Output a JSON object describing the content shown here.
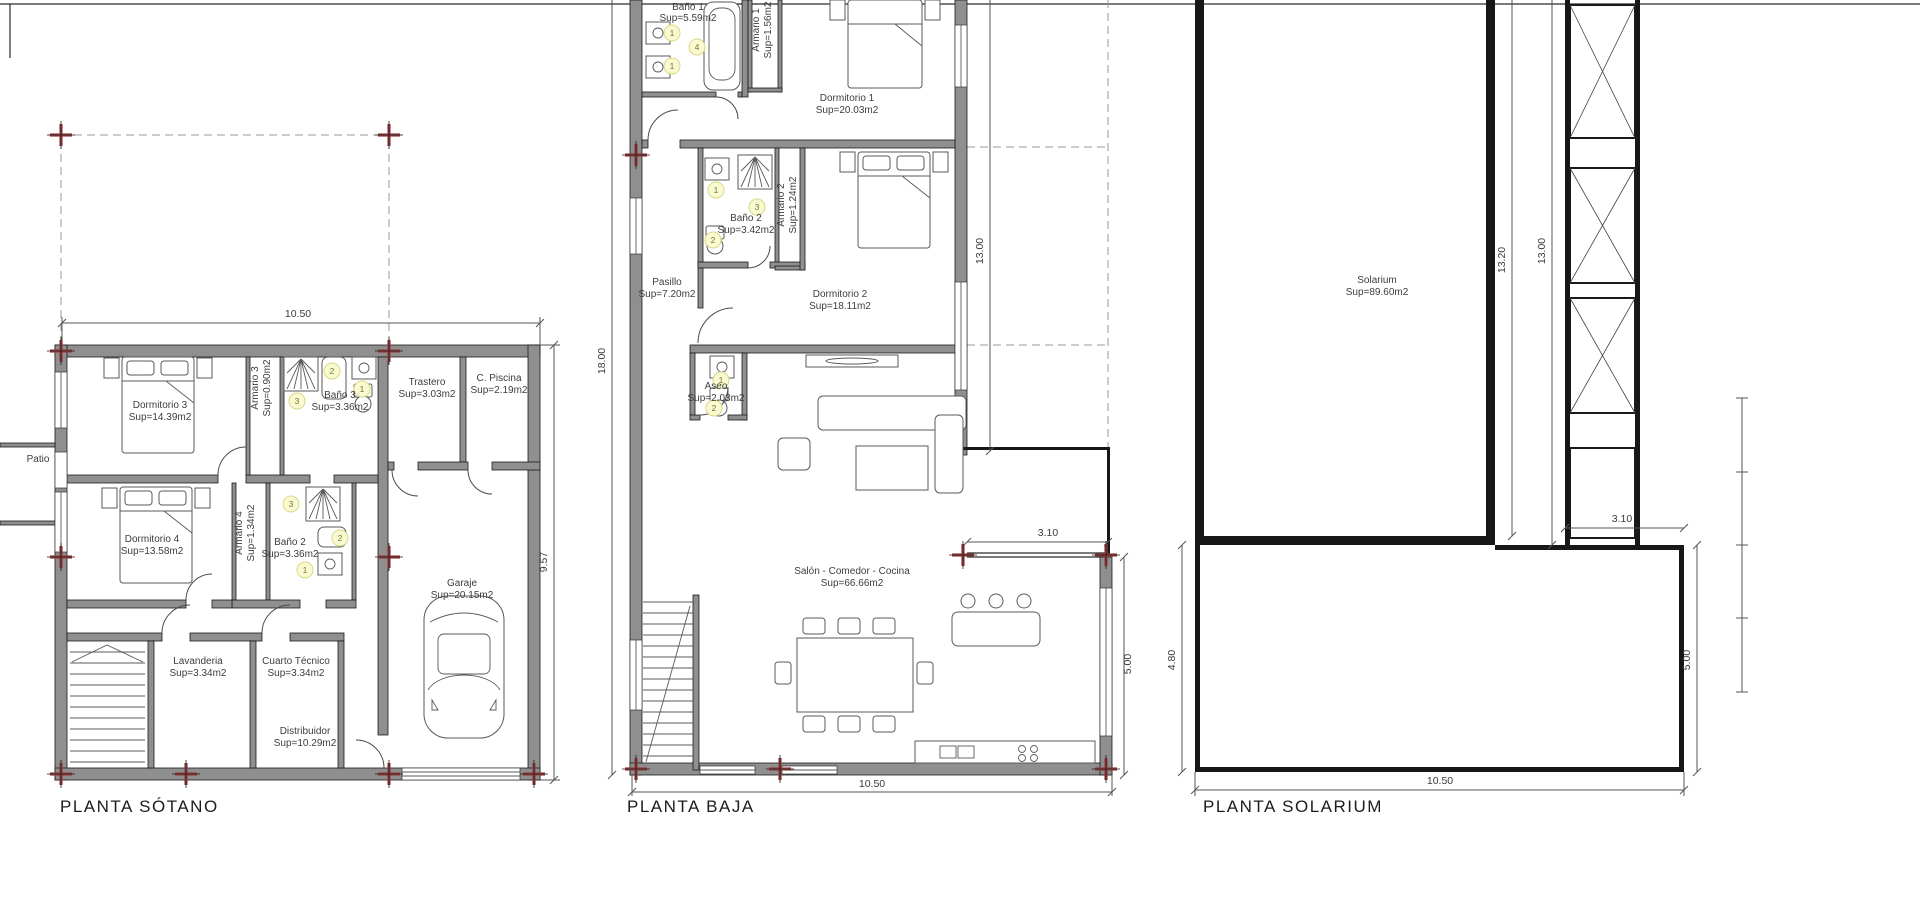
{
  "plans": {
    "sotano": {
      "title": "PLANTA SÓTANO",
      "dims": {
        "width": "10.50",
        "height": "9.57"
      },
      "rooms": {
        "patio": {
          "name": "Patio"
        },
        "dormitorio3": {
          "name": "Dormitorio 3",
          "sup": "Sup=14.39m2"
        },
        "armario3": {
          "name": "Armario 3",
          "sup": "Sup=0.90m2"
        },
        "bano3": {
          "name": "Baño 3",
          "sup": "Sup=3.36m2"
        },
        "trastero": {
          "name": "Trastero",
          "sup": "Sup=3.03m2"
        },
        "cpiscina": {
          "name": "C. Piscina",
          "sup": "Sup=2.19m2"
        },
        "dormitorio4": {
          "name": "Dormitorio 4",
          "sup": "Sup=13.58m2"
        },
        "armario4": {
          "name": "Armario 4",
          "sup": "Sup=1.34m2"
        },
        "bano2": {
          "name": "Baño 2",
          "sup": "Sup=3.36m2"
        },
        "garaje": {
          "name": "Garaje",
          "sup": "Sup=20.15m2"
        },
        "lavanderia": {
          "name": "Lavanderia",
          "sup": "Sup=3.34m2"
        },
        "cuartotecnico": {
          "name": "Cuarto Técnico",
          "sup": "Sup=3.34m2"
        },
        "distribuidor": {
          "name": "Distribuidor",
          "sup": "Sup=10.29m2"
        }
      },
      "markers": {
        "bano3_2": "2",
        "bano3_1": "1",
        "bano3_3": "3",
        "bano2_3": "3",
        "bano2_2": "2",
        "bano2_1": "1"
      }
    },
    "baja": {
      "title": "PLANTA BAJA",
      "dims": {
        "left": "18.00",
        "right_upper": "13.00",
        "terrace_width": "3.10",
        "right_lower": "5.00",
        "bottom": "10.50"
      },
      "rooms": {
        "bano1": {
          "name": "Baño 1",
          "sup": "Sup=5.59m2"
        },
        "armario1": {
          "name": "Armario 1",
          "sup": "Sup=1.56m2"
        },
        "dormitorio1": {
          "name": "Dormitorio 1",
          "sup": "Sup=20.03m2"
        },
        "bano2": {
          "name": "Baño 2",
          "sup": "Sup=3.42m2"
        },
        "armario2": {
          "name": "Armario 2",
          "sup": "Sup=1.24m2"
        },
        "pasillo": {
          "name": "Pasillo",
          "sup": "Sup=7.20m2"
        },
        "dormitorio2": {
          "name": "Dormitorio 2",
          "sup": "Sup=18.11m2"
        },
        "aseo": {
          "name": "Aseo",
          "sup": "Sup=2.03m2"
        },
        "salon": {
          "name": "Salón - Comedor - Cocina",
          "sup": "Sup=66.66m2"
        }
      },
      "markers": {
        "bano1_1a": "1",
        "bano1_1b": "1",
        "bano1_4": "4",
        "bano2_1": "1",
        "bano2_3": "3",
        "bano2_2": "2",
        "aseo_1": "1",
        "aseo_2": "2"
      }
    },
    "solarium": {
      "title": "PLANTA SOLARIUM",
      "dims": {
        "main_height": "13.20",
        "tower_height": "13.00",
        "terrace_width": "3.10",
        "terrace_left": "4.80",
        "terrace_right": "5.00",
        "bottom": "10.50"
      },
      "rooms": {
        "solarium": {
          "name": "Solarium",
          "sup": "Sup=89.60m2"
        }
      }
    }
  },
  "colors": {
    "wall_gray": "#8f8f8f",
    "wall_black": "#171717",
    "grid_cross": "#9a4040",
    "marker_fill": "#fafad2"
  }
}
